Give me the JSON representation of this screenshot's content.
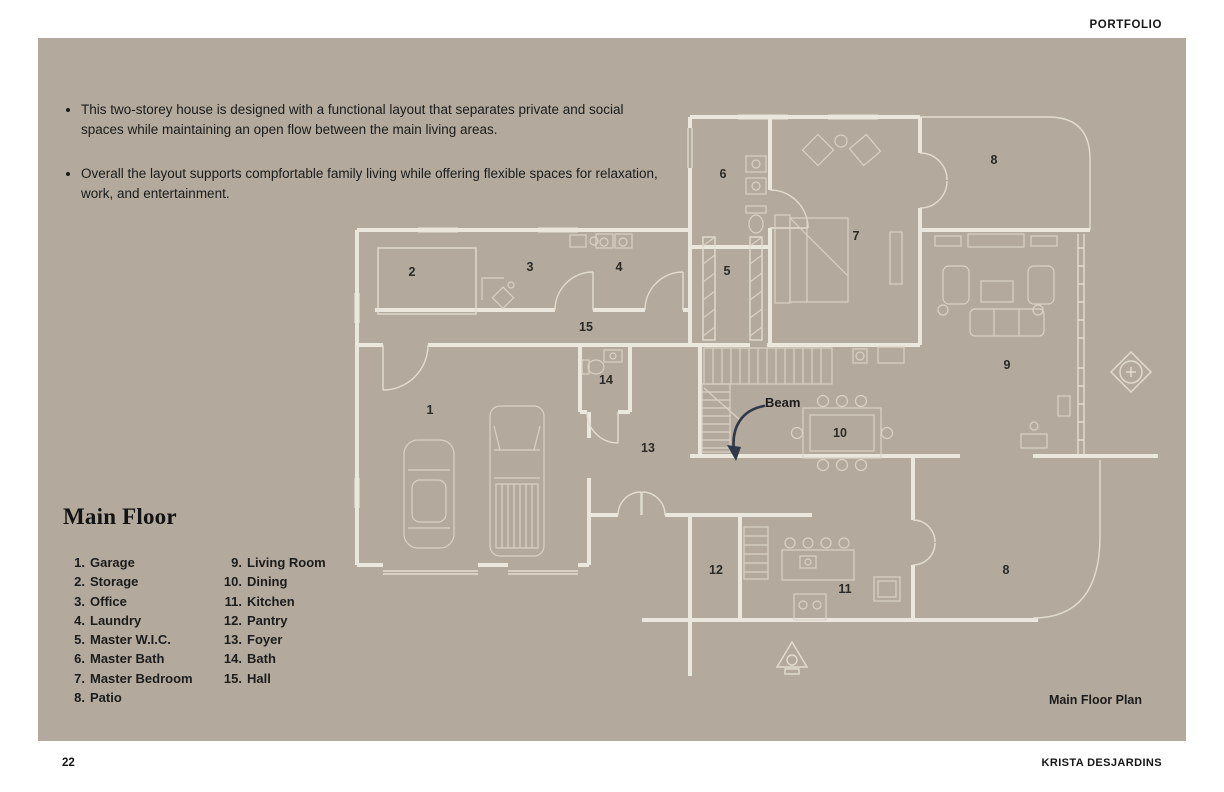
{
  "header": {
    "label": "PORTFOLIO"
  },
  "intro_bullets": [
    "This two-storey house is designed with a functional layout that separates private and social spaces while maintaining an open flow between the main living areas.",
    "Overall the layout supports compfortable family living while offering flexible spaces for relaxation, work, and entertainment."
  ],
  "legend": {
    "title": "Main Floor",
    "col1": [
      {
        "num": "1.",
        "label": "Garage"
      },
      {
        "num": "2.",
        "label": "Storage"
      },
      {
        "num": "3.",
        "label": "Office"
      },
      {
        "num": "4.",
        "label": "Laundry"
      },
      {
        "num": "5.",
        "label": "Master W.I.C."
      },
      {
        "num": "6.",
        "label": "Master Bath"
      },
      {
        "num": "7.",
        "label": "Master Bedroom"
      },
      {
        "num": "8.",
        "label": "Patio"
      }
    ],
    "col2": [
      {
        "num": "9.",
        "label": "Living Room"
      },
      {
        "num": "10.",
        "label": "Dining"
      },
      {
        "num": "11.",
        "label": "Kitchen"
      },
      {
        "num": "12.",
        "label": "Pantry"
      },
      {
        "num": "13.",
        "label": "Foyer"
      },
      {
        "num": "14.",
        "label": "Bath"
      },
      {
        "num": "15.",
        "label": "Hall"
      }
    ]
  },
  "plan": {
    "caption": "Main Floor Plan",
    "beam_label": "Beam",
    "room_numbers": {
      "garage": "1",
      "storage": "2",
      "office": "3",
      "laundry": "4",
      "master_wic": "5",
      "master_bath": "6",
      "master_bedroom": "7",
      "patio_top": "8",
      "living_room": "9",
      "dining": "10",
      "kitchen": "11",
      "pantry": "12",
      "foyer": "13",
      "bath": "14",
      "hall": "15",
      "patio_bottom": "8"
    }
  },
  "footer": {
    "page_number": "22",
    "author": "KRISTA DESJARDINS"
  },
  "colors": {
    "canvas_bg": "#b3aa9d",
    "wall": "#ece7dd",
    "wall_thin": "#e3ddd0",
    "furniture": "#d9d2c5",
    "beam_arrow": "#2e3848",
    "text": "#1f1f1f"
  }
}
